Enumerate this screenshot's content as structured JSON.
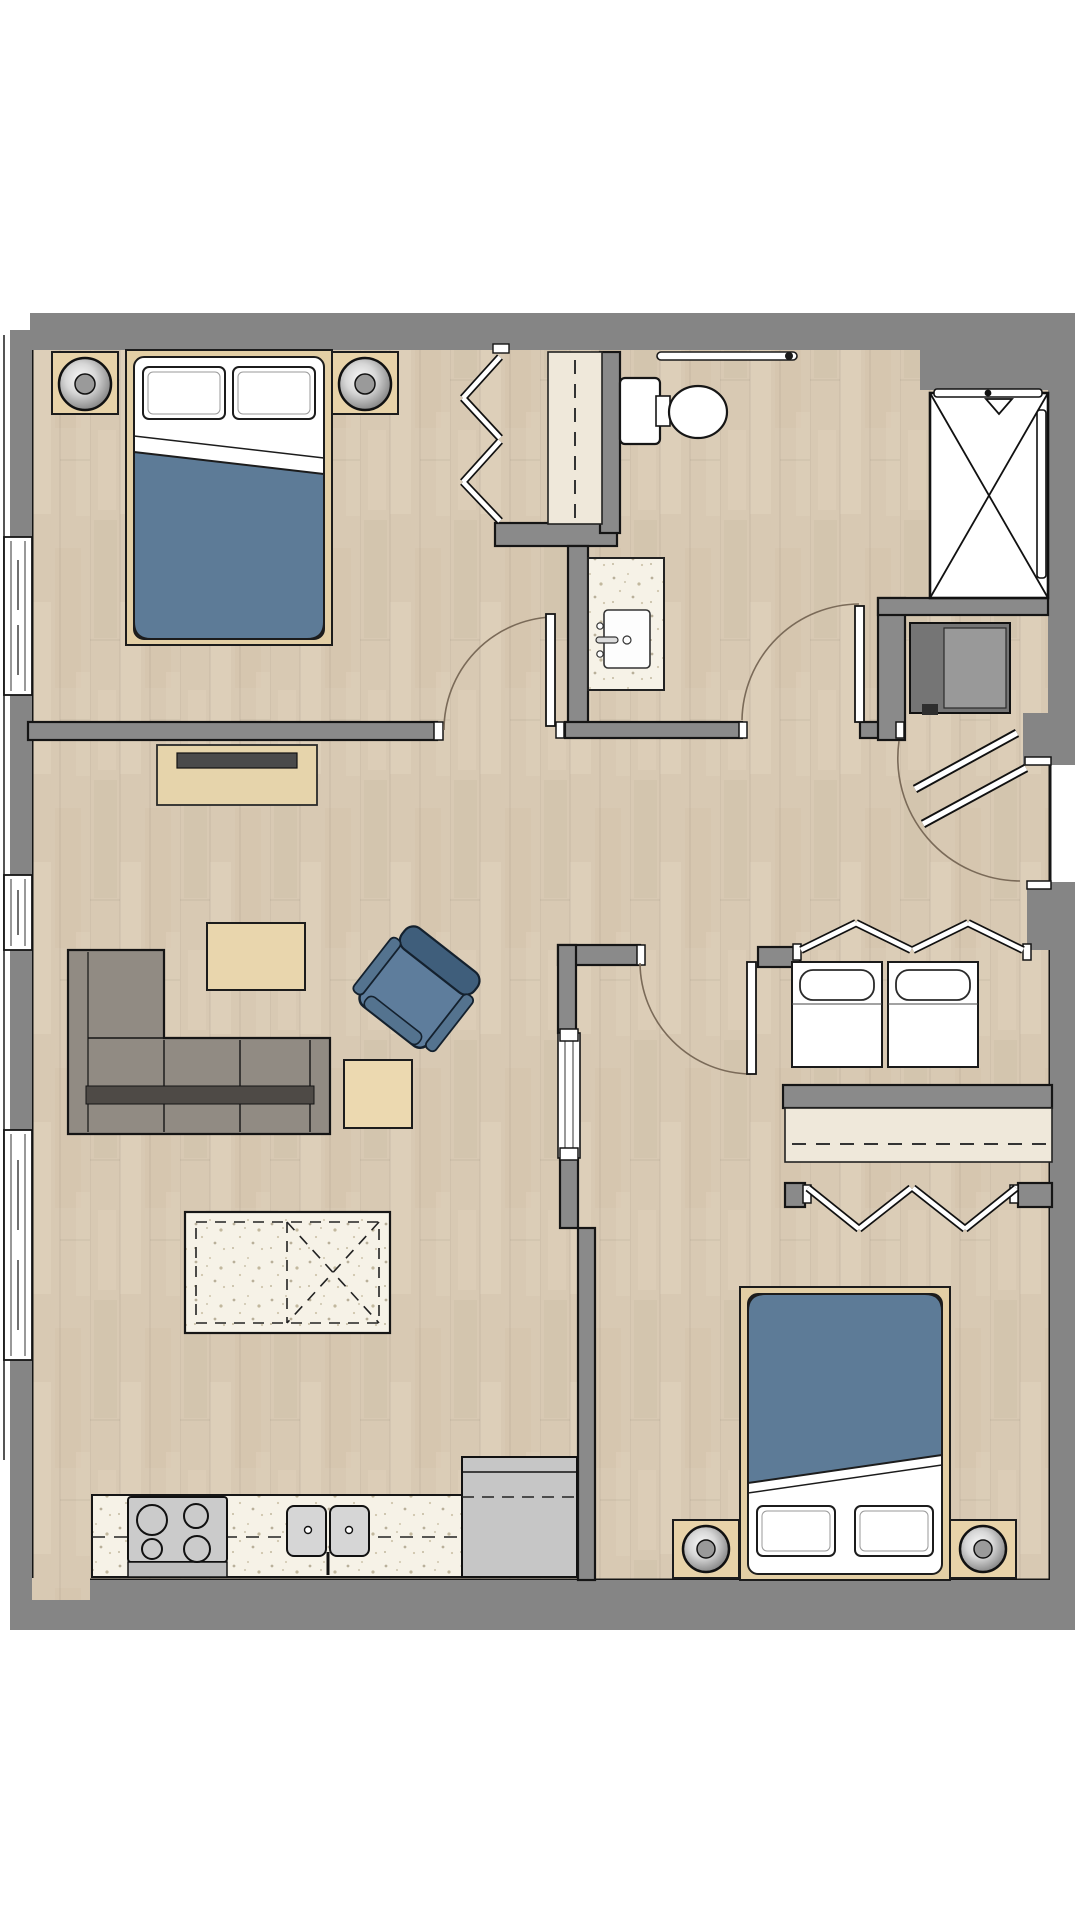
{
  "meta": {
    "title": "Two-bedroom apartment floor plan",
    "view": "top-down architectural rendering",
    "visible_text": "none"
  },
  "palette": {
    "wall_gray": "#858585",
    "wall_outline": "#151515",
    "floor_wood": "#d8c9b3",
    "counter_speckle": "#f6f2e7",
    "closet_shelf": "#efe8da",
    "duvet_blue": "#5d7b97",
    "armchair_blue": "#5e7d9c",
    "sofa_gray": "#918b83",
    "sofa_dark_strip": "#4e4a46",
    "furniture_wood": "#e3cfa5",
    "appliance_gray": "#c6c6c6",
    "water_heater_gray": "#757575",
    "tv_dark": "#4a4a4a",
    "fixture_white": "#ffffff",
    "swing_arc": "#7a6a58",
    "background": "#ffffff"
  },
  "rooms": {
    "bedroom1": {
      "label": "Bedroom 1",
      "furniture": [
        "double-bed-blue-duvet",
        "pillow",
        "pillow",
        "nightstand-with-lamp-left",
        "nightstand-with-lamp-right",
        "bifold-closet-with-shelf-and-rod"
      ],
      "windows": 1
    },
    "living": {
      "label": "Living room",
      "furniture": [
        "l-shaped-sectional-sofa",
        "coffee-table",
        "side-table",
        "swivel-armchair-blue",
        "media-console-with-tv"
      ],
      "windows": 2
    },
    "kitchen": {
      "label": "Kitchen",
      "furniture": [
        "island-with-dashed-cabinet-outline",
        "range-4-burners-with-oven",
        "double-basin-sink-with-faucet",
        "refrigerator",
        "upper-cabinet-dashed-line"
      ]
    },
    "bathroom": {
      "label": "Bathroom",
      "furniture": [
        "toilet",
        "vanity-with-sink-and-faucet",
        "towel-bar",
        "shower-with-glass-door-and-shower-head"
      ]
    },
    "hall": {
      "label": "Entry hall",
      "furniture": [
        "double-entry-door",
        "water-heater-niche"
      ]
    },
    "laundry": {
      "label": "Laundry closet",
      "furniture": [
        "washer",
        "dryer",
        "bifold-doors"
      ]
    },
    "bedroom2": {
      "label": "Bedroom 2",
      "furniture": [
        "double-bed-blue-duvet",
        "pillow",
        "pillow",
        "nightstand-with-lamp-left",
        "nightstand-with-lamp-right",
        "bifold-closet-with-shelf-and-rod",
        "pocket-door-to-kitchen"
      ],
      "windows": 0
    }
  },
  "counts": {
    "swing_doors": 4,
    "bifold_door_pairs": 3,
    "exterior_windows": 3,
    "beds": 2,
    "table_lamps": 4
  }
}
